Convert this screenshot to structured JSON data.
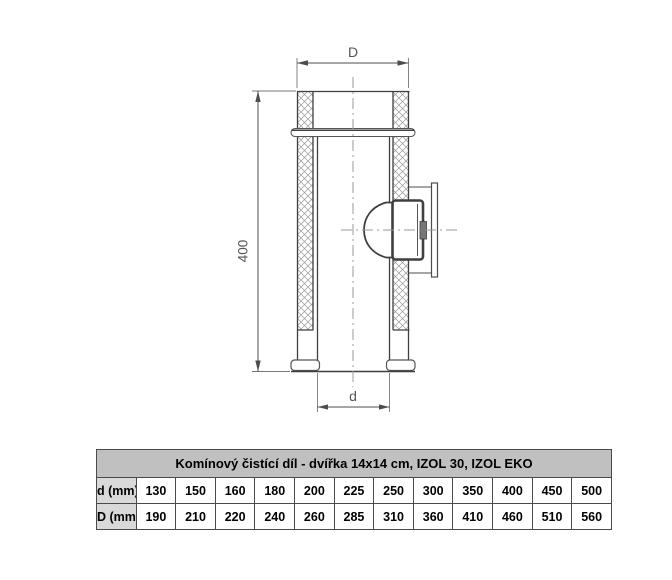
{
  "diagram": {
    "dim_top_label": "D",
    "dim_bottom_label": "d",
    "dim_left_label": "400"
  },
  "table": {
    "title": "Komínový čistící díl - dvířka 14x14 cm, IZOL 30, IZOL EKO",
    "rows": [
      {
        "label": "d (mm)",
        "values": [
          "130",
          "150",
          "160",
          "180",
          "200",
          "225",
          "250",
          "300",
          "350",
          "400",
          "450",
          "500"
        ]
      },
      {
        "label": "D (mm)",
        "values": [
          "190",
          "210",
          "220",
          "240",
          "260",
          "285",
          "310",
          "360",
          "410",
          "460",
          "510",
          "560"
        ]
      }
    ]
  },
  "colors": {
    "table_header_bg": "#c0c0c0",
    "table_label_bg": "#d9d9d9",
    "table_border": "#4a4a4a",
    "drawing_line": "#3f3f3f",
    "dimension_line": "#4d4d4d",
    "centerline": "#999999",
    "hatch": "#999999"
  }
}
